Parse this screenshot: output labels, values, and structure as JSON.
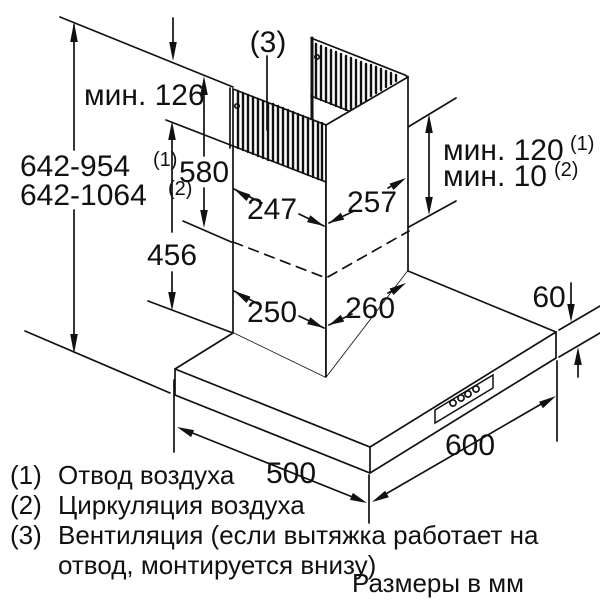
{
  "diagram": {
    "total_height_1": "642-954",
    "total_height_1_sup": "(1)",
    "total_height_2": "642-1064",
    "total_height_2_sup": "(2)",
    "min_126": "мин. 126",
    "upper_section_580": "580",
    "lower_section_456": "456",
    "top_width_left_247": "247",
    "top_width_right_257": "257",
    "mid_width_left_250": "250",
    "mid_width_right_260": "260",
    "min_120": "мин. 120",
    "min_120_sup": "(1)",
    "min_10": "мин. 10",
    "min_10_sup": "(2)",
    "hood_edge_60": "60",
    "hood_depth_500": "500",
    "hood_width_600": "600",
    "callout_3": "(3)"
  },
  "legend": {
    "items": [
      {
        "num": "(1)",
        "text": "Отвод воздуха"
      },
      {
        "num": "(2)",
        "text": "Циркуляция воздуха"
      },
      {
        "num": "(3)",
        "text": "Вентиляция (если вытяжка работает на отвод, монтируется внизу)"
      }
    ],
    "units_note": "Размеры в мм"
  },
  "colors": {
    "line": "#111111",
    "background": "#ffffff"
  }
}
